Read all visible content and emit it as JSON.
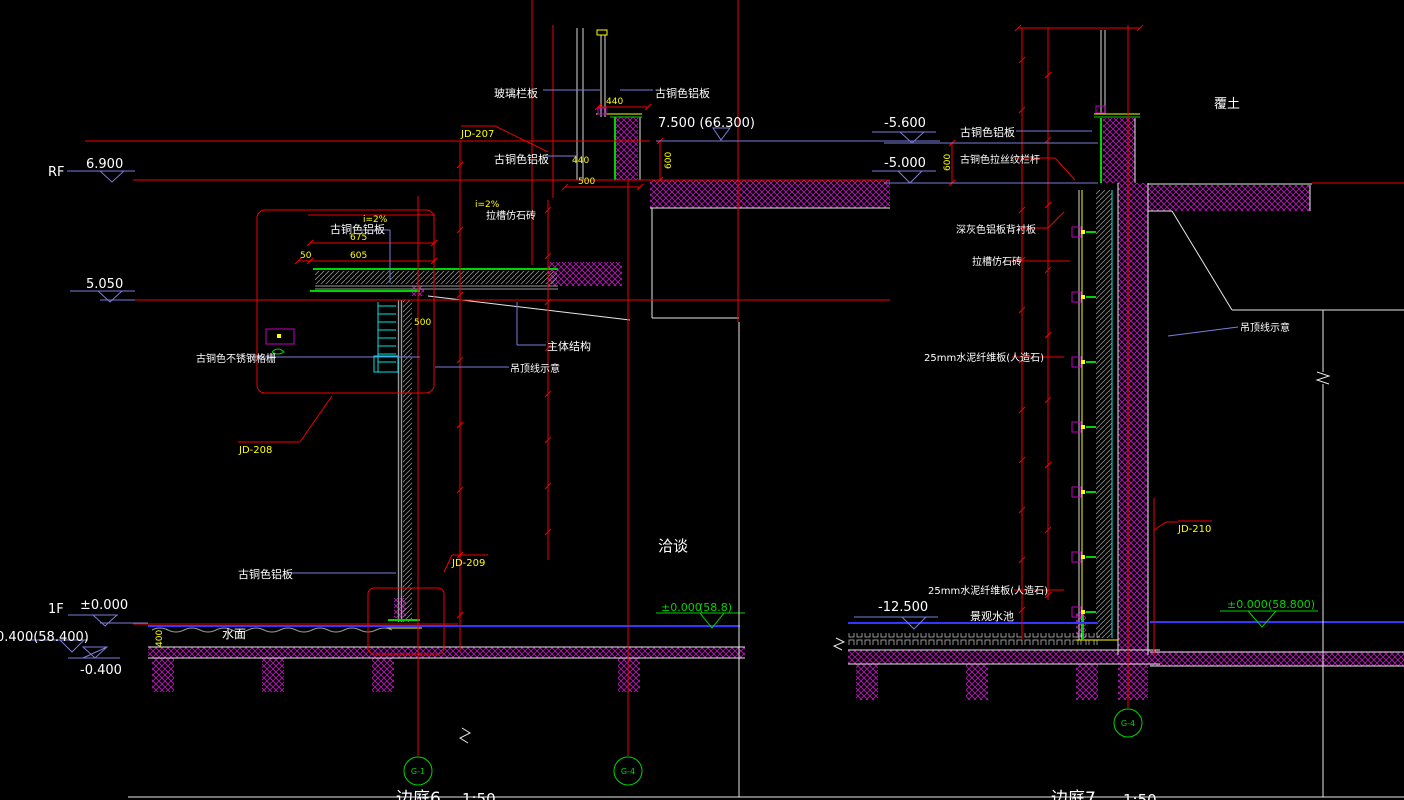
{
  "colors": {
    "background": "#000000",
    "dimension_red": "#f00000",
    "annotation_yellow": "#ffff00",
    "leader_blue": "#7d7dd8",
    "water_blue": "#3535ff",
    "grid_green": "#00d400",
    "concrete_hatch": "#b517b5",
    "text_white": "#ffffff"
  },
  "left": {
    "caption": "边庭6",
    "caption_scale": "1:50",
    "lv_rf_tag": "RF",
    "lv_rf": "6.900",
    "lv_mid": "5.050",
    "lv_top": "7.500 (66.300)",
    "lv_f1_tag": "1F",
    "lv_f1": "±0.000",
    "lv_low": "0.400(58.400)",
    "lv_neg": "-0.400",
    "lv_zero": "±0.000",
    "lv_zero_note": "(58.8)",
    "lbl_glass_rail": "玻璃栏板",
    "lbl_bronze_top": "古铜色铝板",
    "lbl_bronze_mid": "古铜色铝板",
    "lbl_bronze_canopy": "古铜色铝板",
    "lbl_bronze_base": "古铜色铝板",
    "lbl_grille": "古铜色不锈钢格栅",
    "lbl_structure": "主体结构",
    "lbl_ceiling": "吊顶线示意",
    "lbl_stone": "拉槽仿石砖",
    "lbl_slope_top": "i=2%",
    "lbl_slope_canopy": "i=2%",
    "lbl_water": "水面",
    "lbl_room": "洽谈",
    "ref1": "JD-207",
    "ref2": "JD-208",
    "ref3": "JD-209",
    "dim_675": "675",
    "dim_605": "605",
    "dim_50": "50",
    "dim_500a": "500",
    "dim_500b": "500",
    "dim_440a": "440",
    "dim_440b": "440",
    "dim_400": "400",
    "dim_600": "600",
    "grid1": "G-1",
    "grid2": "G-4"
  },
  "right": {
    "caption": "边庭7",
    "caption_scale": "1:50",
    "lv_a": "-5.600",
    "lv_b": "-5.000",
    "lv_c": "-12.500",
    "lv_zero": "±0.000",
    "lv_zero_note": "(58.800)",
    "lbl_earth": "覆土",
    "lbl_bronze": "古铜色铝板",
    "lbl_rail": "古铜色拉丝纹栏杆",
    "lbl_gray_panel": "深灰色铝板背衬板",
    "lbl_stone": "拉槽仿石砖",
    "lbl_fiber1": "25mm水泥纤维板(人造石)",
    "lbl_fiber2": "25mm水泥纤维板(人造石)",
    "lbl_pool": "景观水池",
    "lbl_ceiling": "吊顶线示意",
    "ref1": "JD-210",
    "dim_600": "600",
    "grid1": "G-4"
  }
}
